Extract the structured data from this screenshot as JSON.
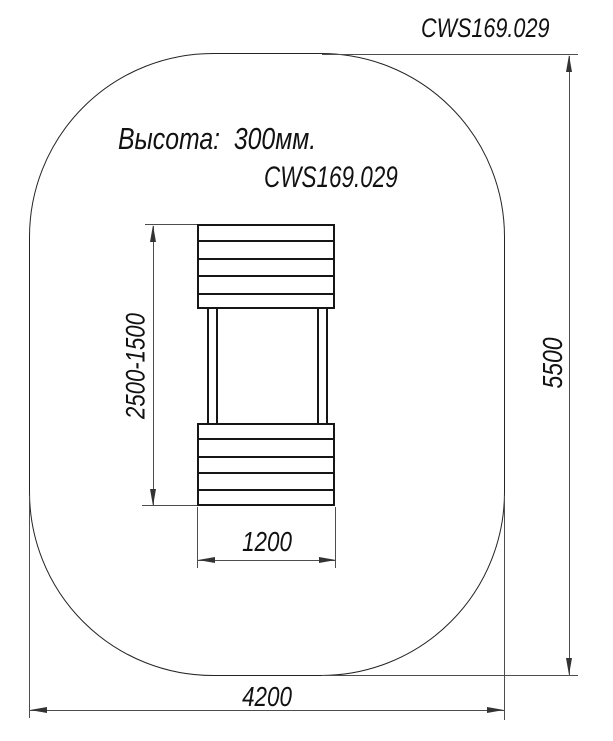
{
  "drawing": {
    "title": "CWS169.029",
    "height_note": "Высота:  300мм.",
    "model_code": "CWS169.029"
  },
  "dimensions": {
    "height_range": "2500-1500",
    "inner_width": "1200",
    "zone_height": "5500",
    "zone_width": "4200"
  },
  "colors": {
    "background": "#ffffff",
    "object_line": "#1a1a1a",
    "dimension_line": "#4d4d4d",
    "arrow": "#333333",
    "text": "#111111"
  }
}
